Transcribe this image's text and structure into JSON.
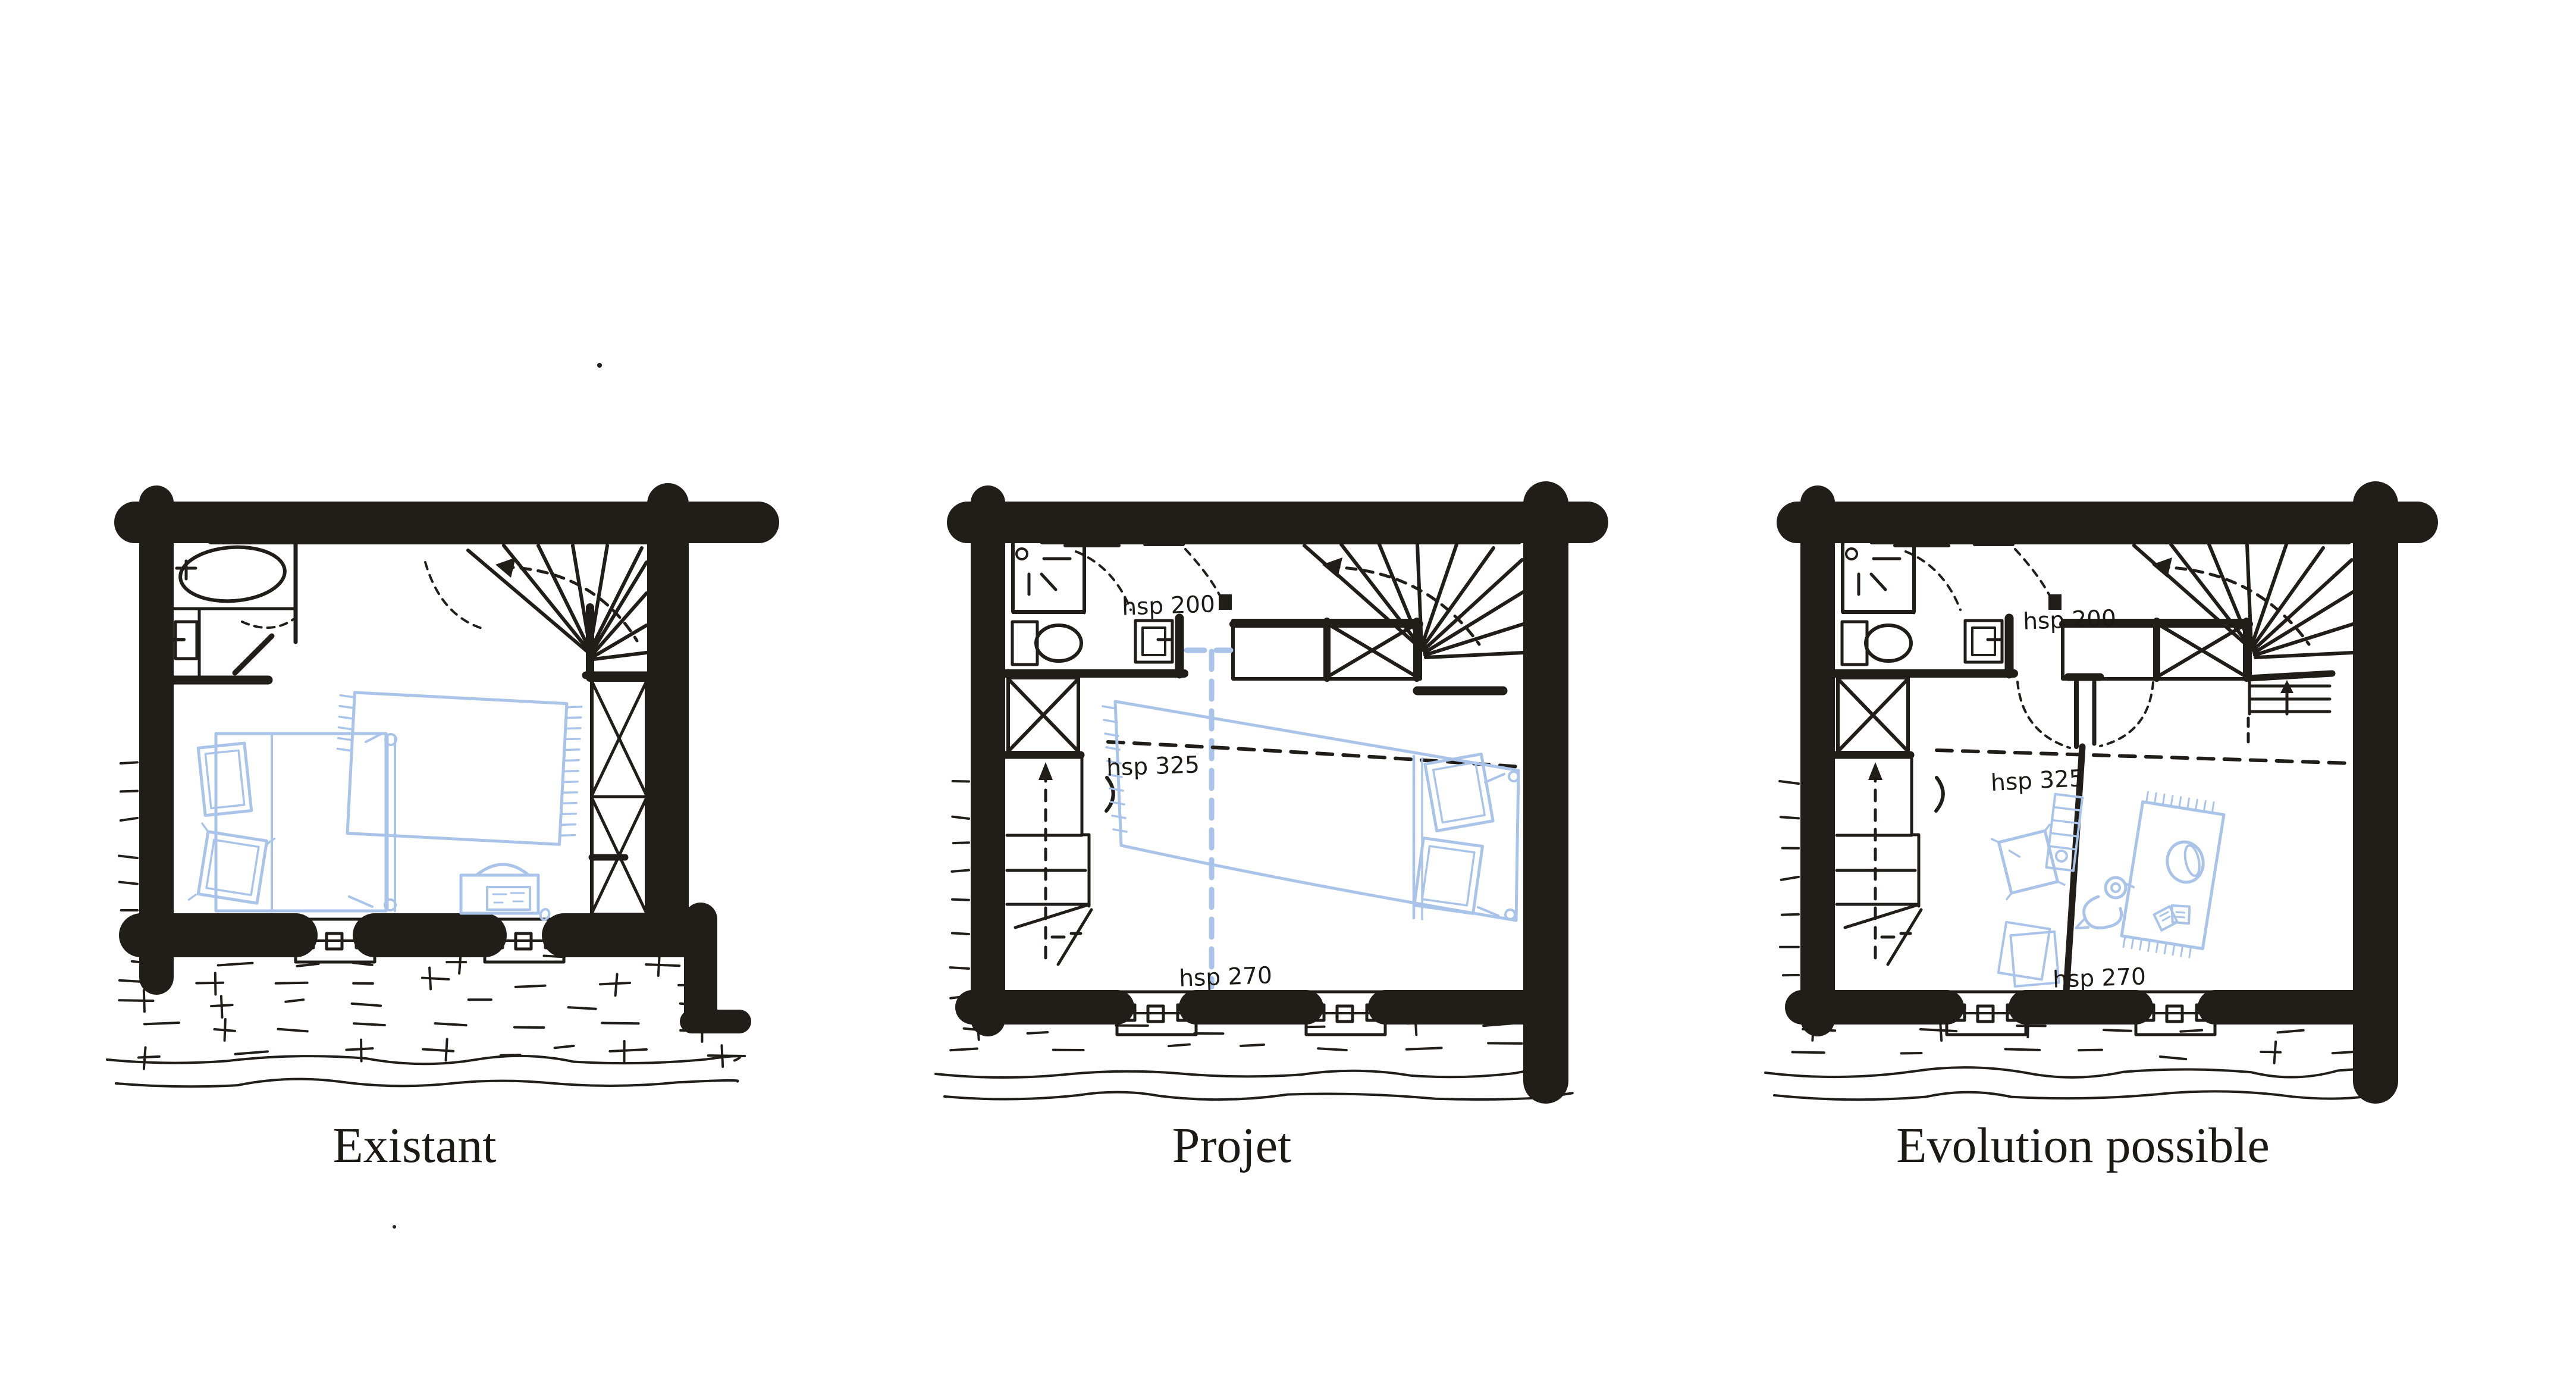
{
  "artwork": {
    "type": "hand-drawn floor plan comparison sketch",
    "background": "#ffffff",
    "ink_color": "#211d18",
    "furniture_color": "#a9c4e8"
  },
  "plans": [
    {
      "id": "existant",
      "label": "Existant",
      "annotations": {},
      "depicts": [
        "exterior walls",
        "bathtub",
        "washbasin",
        "bathroom partition and door",
        "winder staircase",
        "built-in wardrobe",
        "double bed with two pillows",
        "fringed blanket",
        "desk with chair",
        "two windows",
        "ground hatching"
      ]
    },
    {
      "id": "projet",
      "label": "Projet",
      "annotations": {
        "hall_height": "hsp 200",
        "room_height": "hsp 325",
        "low_height": "hsp 270"
      },
      "depicts": [
        "exterior walls",
        "shower",
        "toilet",
        "washbasin",
        "winder staircase with storage landing",
        "new straight staircase",
        "wardrobe",
        "double bed against right wall",
        "proposed partition as blue dashed lines",
        "two windows",
        "ground hatching"
      ]
    },
    {
      "id": "evolution",
      "label": "Evolution possible",
      "annotations": {
        "hall_height": "hsp 200",
        "room_height": "hsp 325",
        "low_height": "hsp 270"
      },
      "depicts": [
        "exterior walls",
        "shower",
        "toilet",
        "washbasin",
        "winder staircase with storage landing",
        "straight staircase with up arrow",
        "wardrobe",
        "new central partition with double doors",
        "cushion",
        "papers",
        "ladder toy",
        "pull-along duck toy",
        "play rug",
        "basket",
        "open book",
        "two windows",
        "ground hatching"
      ]
    }
  ]
}
